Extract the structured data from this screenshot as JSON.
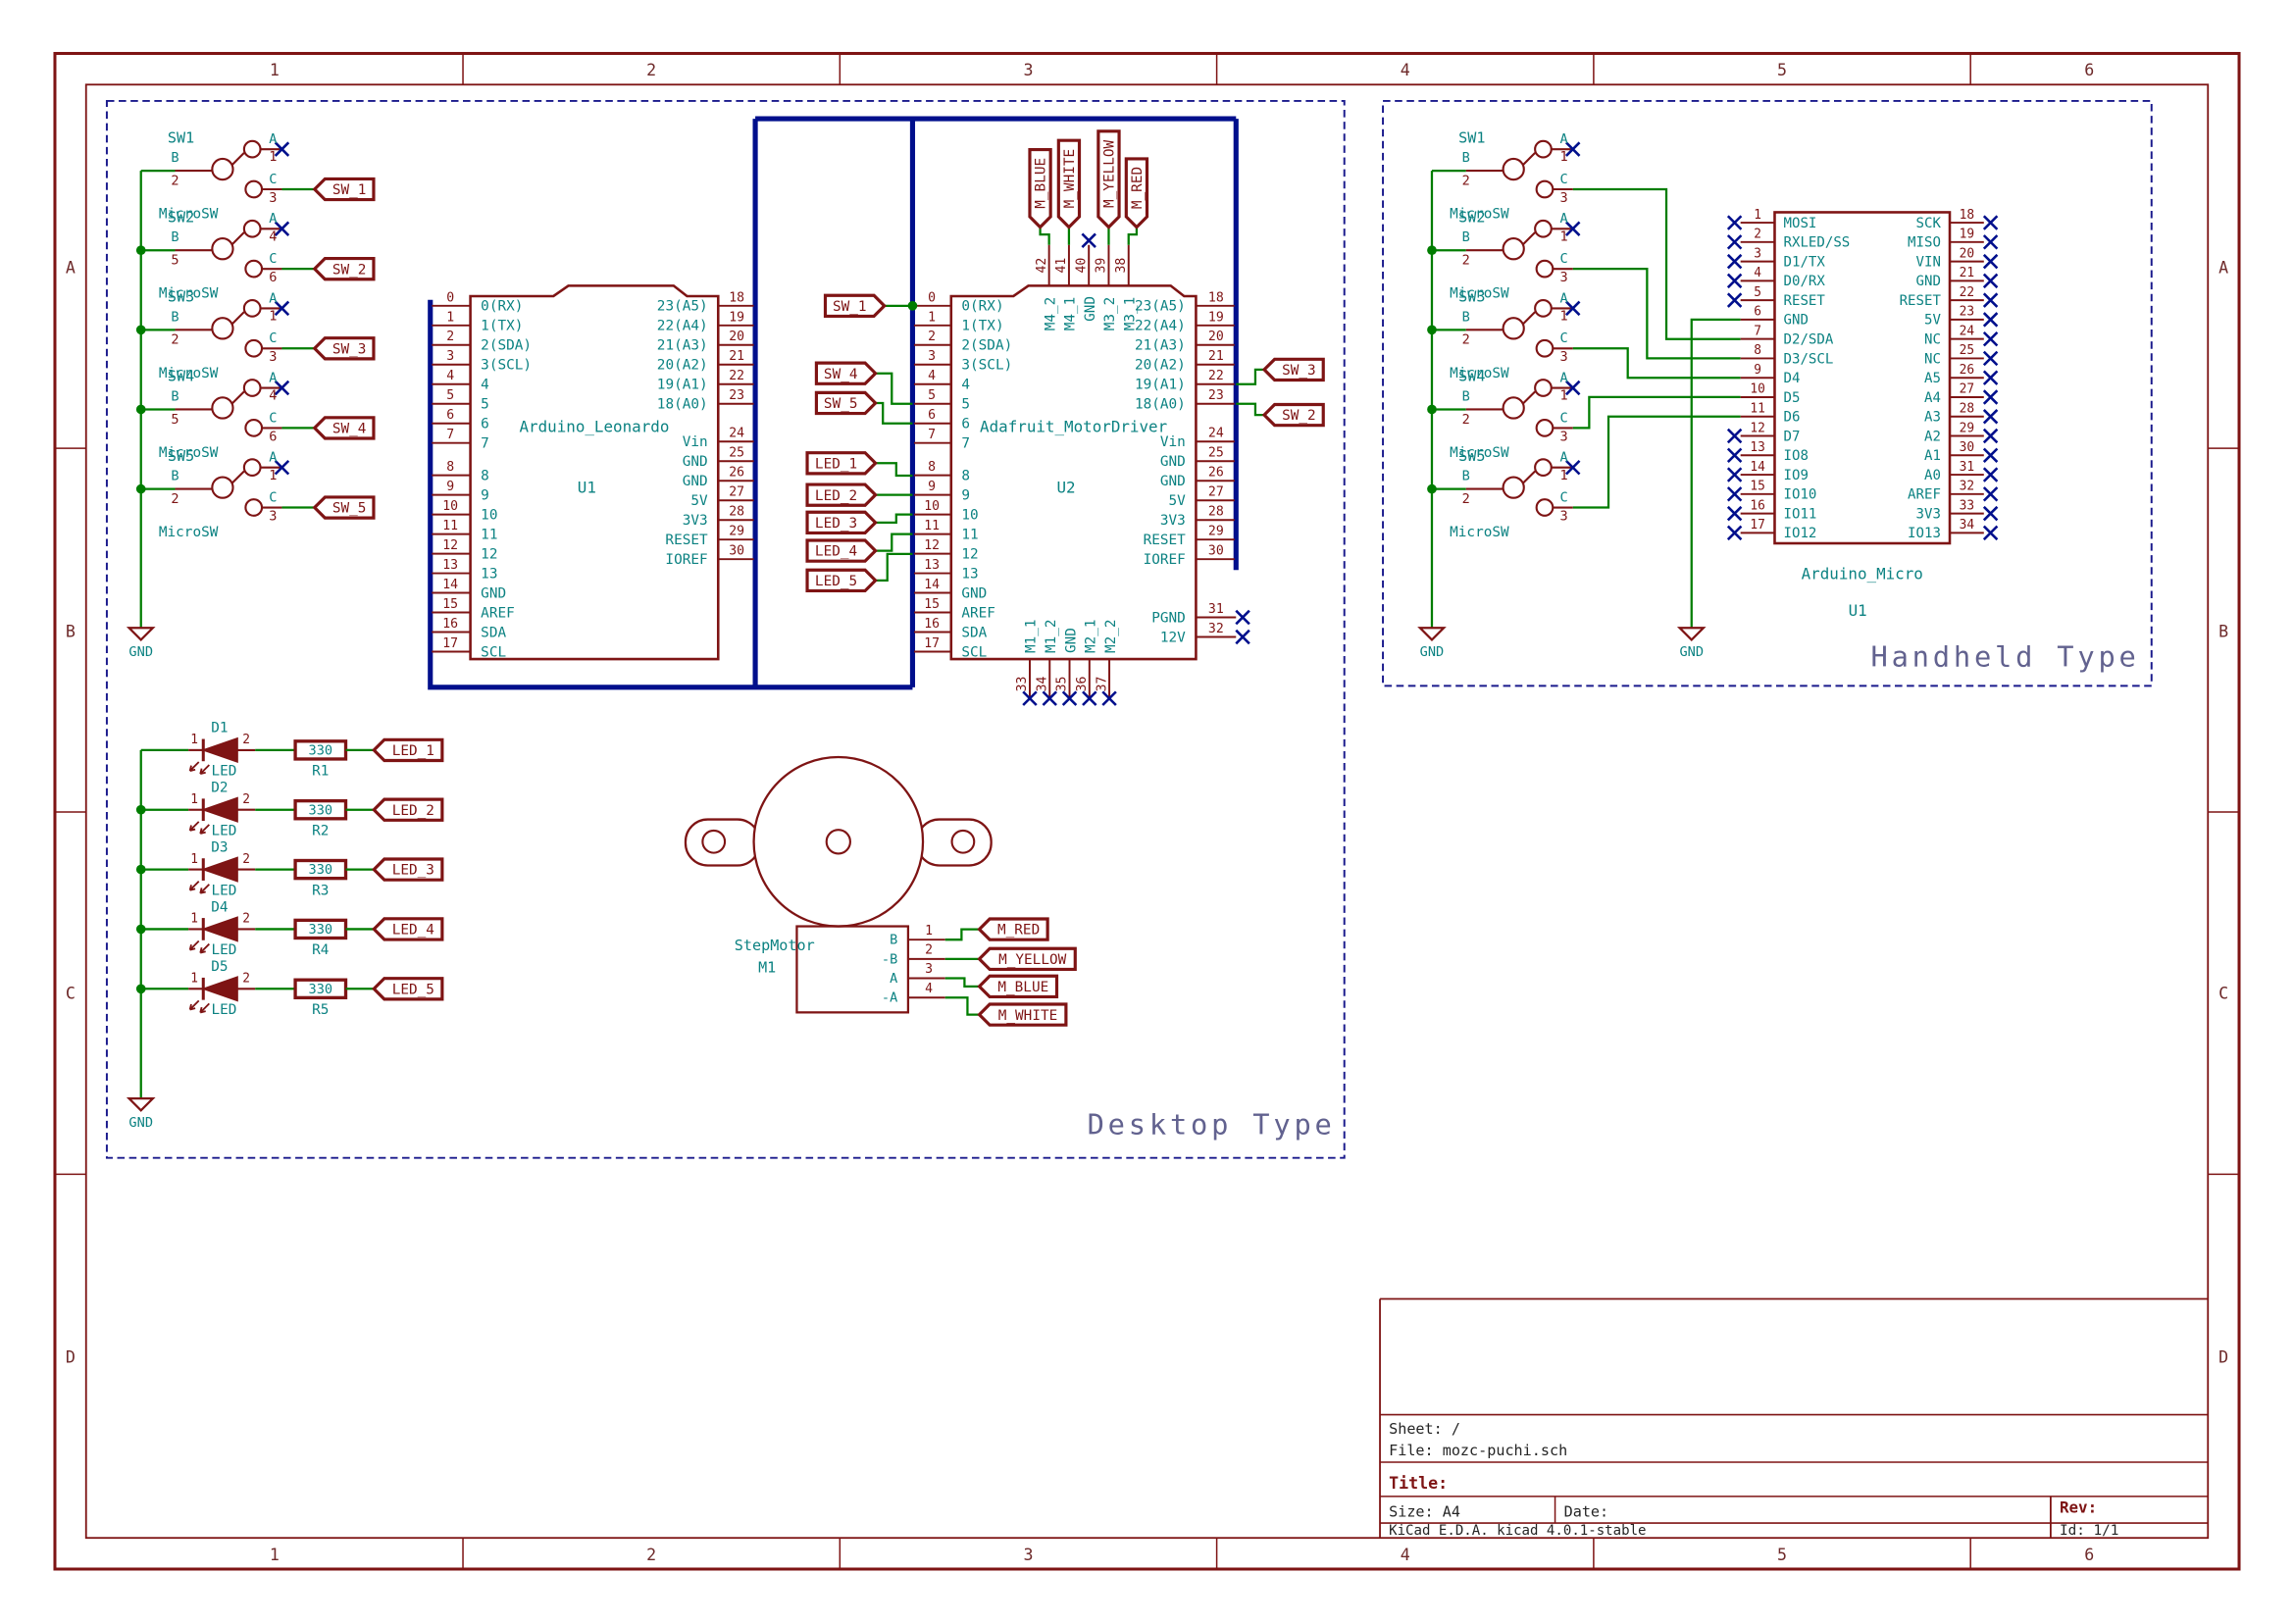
{
  "frame": {
    "columns": [
      "1",
      "2",
      "3",
      "4",
      "5",
      "6"
    ],
    "rows": [
      "A",
      "B",
      "C",
      "D"
    ]
  },
  "title_block": {
    "sheet": "Sheet: /",
    "file": "File: mozc-puchi.sch",
    "title_label": "Title:",
    "size": "Size: A4",
    "date": "Date:",
    "rev": "Rev:",
    "generator": "KiCad E.D.A.  kicad 4.0.1-stable",
    "id": "Id: 1/1"
  },
  "colors": {
    "component": "#7e1414",
    "field_text": "#0c8282",
    "wire": "#007d00",
    "bus": "#000f8c",
    "no_connect": "#000f8c",
    "label": "#7e1414",
    "sheet_box": "#1a1a8c",
    "sheet_text": "#62628f",
    "frame": "#7e1414",
    "frame_text": "#6e2a2a",
    "block_text": "#252525"
  },
  "desktop": {
    "section_label": "Desktop Type",
    "gnd": "GND",
    "switches": [
      {
        "ref": "SW1",
        "value": "MicroSW",
        "b": "B",
        "a": "A",
        "c": "C",
        "pin_b": "2",
        "pin_a": "1",
        "pin_c": "3",
        "net": "SW_1"
      },
      {
        "ref": "SW2",
        "value": "MicroSW",
        "b": "B",
        "a": "A",
        "c": "C",
        "pin_b": "5",
        "pin_a": "4",
        "pin_c": "6",
        "net": "SW_2"
      },
      {
        "ref": "SW3",
        "value": "MicroSW",
        "b": "B",
        "a": "A",
        "c": "C",
        "pin_b": "2",
        "pin_a": "1",
        "pin_c": "3",
        "net": "SW_3"
      },
      {
        "ref": "SW4",
        "value": "MicroSW",
        "b": "B",
        "a": "A",
        "c": "C",
        "pin_b": "5",
        "pin_a": "4",
        "pin_c": "6",
        "net": "SW_4"
      },
      {
        "ref": "SW5",
        "value": "MicroSW",
        "b": "B",
        "a": "A",
        "c": "C",
        "pin_b": "2",
        "pin_a": "1",
        "pin_c": "3",
        "net": "SW_5"
      }
    ],
    "u1": {
      "ref": "U1",
      "name": "Arduino_Leonardo",
      "left_pins": [
        {
          "num": "0",
          "name": "0(RX)"
        },
        {
          "num": "1",
          "name": "1(TX)"
        },
        {
          "num": "2",
          "name": "2(SDA)"
        },
        {
          "num": "3",
          "name": "3(SCL)"
        },
        {
          "num": "4",
          "name": "4"
        },
        {
          "num": "5",
          "name": "5"
        },
        {
          "num": "6",
          "name": "6"
        },
        {
          "num": "7",
          "name": "7"
        },
        {
          "num": "8",
          "name": "8"
        },
        {
          "num": "9",
          "name": "9"
        },
        {
          "num": "10",
          "name": "10"
        },
        {
          "num": "11",
          "name": "11"
        },
        {
          "num": "12",
          "name": "12"
        },
        {
          "num": "13",
          "name": "13"
        },
        {
          "num": "14",
          "name": "GND"
        },
        {
          "num": "15",
          "name": "AREF"
        },
        {
          "num": "16",
          "name": "SDA"
        },
        {
          "num": "17",
          "name": "SCL"
        }
      ],
      "right_pins": [
        {
          "num": "18",
          "name": "23(A5)"
        },
        {
          "num": "19",
          "name": "22(A4)"
        },
        {
          "num": "20",
          "name": "21(A3)"
        },
        {
          "num": "21",
          "name": "20(A2)"
        },
        {
          "num": "22",
          "name": "19(A1)"
        },
        {
          "num": "23",
          "name": "18(A0)"
        },
        {
          "num": "24",
          "name": "Vin"
        },
        {
          "num": "25",
          "name": "GND"
        },
        {
          "num": "26",
          "name": "GND"
        },
        {
          "num": "27",
          "name": "5V"
        },
        {
          "num": "28",
          "name": "3V3"
        },
        {
          "num": "29",
          "name": "RESET"
        },
        {
          "num": "30",
          "name": "IOREF"
        }
      ]
    },
    "u2": {
      "ref": "U2",
      "name": "Adafruit_MotorDriver",
      "left_pins": [
        {
          "num": "0",
          "name": "0(RX)"
        },
        {
          "num": "1",
          "name": "1(TX)"
        },
        {
          "num": "2",
          "name": "2(SDA)"
        },
        {
          "num": "3",
          "name": "3(SCL)"
        },
        {
          "num": "4",
          "name": "4"
        },
        {
          "num": "5",
          "name": "5"
        },
        {
          "num": "6",
          "name": "6"
        },
        {
          "num": "7",
          "name": "7"
        },
        {
          "num": "8",
          "name": "8"
        },
        {
          "num": "9",
          "name": "9"
        },
        {
          "num": "10",
          "name": "10"
        },
        {
          "num": "11",
          "name": "11"
        },
        {
          "num": "12",
          "name": "12"
        },
        {
          "num": "13",
          "name": "13"
        },
        {
          "num": "14",
          "name": "GND"
        },
        {
          "num": "15",
          "name": "AREF"
        },
        {
          "num": "16",
          "name": "SDA"
        },
        {
          "num": "17",
          "name": "SCL"
        }
      ],
      "right_pins": [
        {
          "num": "18",
          "name": "23(A5)"
        },
        {
          "num": "19",
          "name": "22(A4)"
        },
        {
          "num": "20",
          "name": "21(A3)"
        },
        {
          "num": "21",
          "name": "20(A2)"
        },
        {
          "num": "22",
          "name": "19(A1)"
        },
        {
          "num": "23",
          "name": "18(A0)"
        },
        {
          "num": "24",
          "name": "Vin"
        },
        {
          "num": "25",
          "name": "GND"
        },
        {
          "num": "26",
          "name": "GND"
        },
        {
          "num": "27",
          "name": "5V"
        },
        {
          "num": "28",
          "name": "3V3"
        },
        {
          "num": "29",
          "name": "RESET"
        },
        {
          "num": "30",
          "name": "IOREF"
        }
      ],
      "top_pins": [
        {
          "num": "42",
          "name": "M4_2",
          "net": "M_BLUE"
        },
        {
          "num": "41",
          "name": "M4_1",
          "net": "M_WHITE"
        },
        {
          "num": "40",
          "name": "GND"
        },
        {
          "num": "39",
          "name": "M3_2",
          "net": "M_YELLOW"
        },
        {
          "num": "38",
          "name": "M3_1",
          "net": "M_RED"
        }
      ],
      "power_pins": [
        {
          "num": "31",
          "name": "PGND"
        },
        {
          "num": "32",
          "name": "12V"
        }
      ],
      "bottom_pins": [
        {
          "num": "33",
          "name": "M1_1"
        },
        {
          "num": "34",
          "name": "M1_2"
        },
        {
          "num": "35",
          "name": "GND"
        },
        {
          "num": "36",
          "name": "M2_1"
        },
        {
          "num": "37",
          "name": "M2_2"
        }
      ],
      "left_nets": [
        "SW_1",
        "SW_4",
        "SW_5",
        "LED_1",
        "LED_2",
        "LED_3",
        "LED_4",
        "LED_5"
      ],
      "right_nets": [
        "SW_3",
        "SW_2"
      ]
    },
    "leds": [
      {
        "ref": "D1",
        "value": "LED",
        "pin1": "1",
        "pin2": "2",
        "res_ref": "R1",
        "res_value": "330",
        "net": "LED_1"
      },
      {
        "ref": "D2",
        "value": "LED",
        "pin1": "1",
        "pin2": "2",
        "res_ref": "R2",
        "res_value": "330",
        "net": "LED_2"
      },
      {
        "ref": "D3",
        "value": "LED",
        "pin1": "1",
        "pin2": "2",
        "res_ref": "R3",
        "res_value": "330",
        "net": "LED_3"
      },
      {
        "ref": "D4",
        "value": "LED",
        "pin1": "1",
        "pin2": "2",
        "res_ref": "R4",
        "res_value": "330",
        "net": "LED_4"
      },
      {
        "ref": "D5",
        "value": "LED",
        "pin1": "1",
        "pin2": "2",
        "res_ref": "R5",
        "res_value": "330",
        "net": "LED_5"
      }
    ],
    "motor": {
      "ref": "M1",
      "name": "StepMotor",
      "pins": [
        {
          "name": "B",
          "num": "1",
          "net": "M_RED"
        },
        {
          "name": "-B",
          "num": "2",
          "net": "M_YELLOW"
        },
        {
          "name": "A",
          "num": "3",
          "net": "M_BLUE"
        },
        {
          "name": "-A",
          "num": "4",
          "net": "M_WHITE"
        }
      ]
    }
  },
  "handheld": {
    "section_label": "Handheld Type",
    "gnd": "GND",
    "switches": [
      {
        "ref": "SW1",
        "value": "MicroSW",
        "b": "B",
        "a": "A",
        "c": "C",
        "pin_b": "2",
        "pin_a": "1",
        "pin_c": "3"
      },
      {
        "ref": "SW2",
        "value": "MicroSW",
        "b": "B",
        "a": "A",
        "c": "C",
        "pin_b": "2",
        "pin_a": "1",
        "pin_c": "3"
      },
      {
        "ref": "SW3",
        "value": "MicroSW",
        "b": "B",
        "a": "A",
        "c": "C",
        "pin_b": "2",
        "pin_a": "1",
        "pin_c": "3"
      },
      {
        "ref": "SW4",
        "value": "MicroSW",
        "b": "B",
        "a": "A",
        "c": "C",
        "pin_b": "2",
        "pin_a": "1",
        "pin_c": "3"
      },
      {
        "ref": "SW5",
        "value": "MicroSW",
        "b": "B",
        "a": "A",
        "c": "C",
        "pin_b": "2",
        "pin_a": "1",
        "pin_c": "3"
      }
    ],
    "micro": {
      "ref": "U1",
      "name": "Arduino_Micro",
      "left_pins": [
        {
          "num": "1",
          "name": "MOSI",
          "nc": true
        },
        {
          "num": "2",
          "name": "RXLED/SS",
          "nc": true
        },
        {
          "num": "3",
          "name": "D1/TX",
          "nc": true
        },
        {
          "num": "4",
          "name": "D0/RX",
          "nc": true
        },
        {
          "num": "5",
          "name": "RESET",
          "nc": true
        },
        {
          "num": "6",
          "name": "GND"
        },
        {
          "num": "7",
          "name": "D2/SDA"
        },
        {
          "num": "8",
          "name": "D3/SCL"
        },
        {
          "num": "9",
          "name": "D4"
        },
        {
          "num": "10",
          "name": "D5"
        },
        {
          "num": "11",
          "name": "D6"
        },
        {
          "num": "12",
          "name": "D7",
          "nc": true
        },
        {
          "num": "13",
          "name": "IO8",
          "nc": true
        },
        {
          "num": "14",
          "name": "IO9",
          "nc": true
        },
        {
          "num": "15",
          "name": "IO10",
          "nc": true
        },
        {
          "num": "16",
          "name": "IO11",
          "nc": true
        },
        {
          "num": "17",
          "name": "IO12",
          "nc": true
        }
      ],
      "right_pins": [
        {
          "num": "18",
          "name": "SCK",
          "nc": true
        },
        {
          "num": "19",
          "name": "MISO",
          "nc": true
        },
        {
          "num": "20",
          "name": "VIN",
          "nc": true
        },
        {
          "num": "21",
          "name": "GND",
          "nc": true
        },
        {
          "num": "22",
          "name": "RESET",
          "nc": true
        },
        {
          "num": "23",
          "name": "5V",
          "nc": true
        },
        {
          "num": "24",
          "name": "NC",
          "nc": true
        },
        {
          "num": "25",
          "name": "NC",
          "nc": true
        },
        {
          "num": "26",
          "name": "A5",
          "nc": true
        },
        {
          "num": "27",
          "name": "A4",
          "nc": true
        },
        {
          "num": "28",
          "name": "A3",
          "nc": true
        },
        {
          "num": "29",
          "name": "A2",
          "nc": true
        },
        {
          "num": "30",
          "name": "A1",
          "nc": true
        },
        {
          "num": "31",
          "name": "A0",
          "nc": true
        },
        {
          "num": "32",
          "name": "AREF",
          "nc": true
        },
        {
          "num": "33",
          "name": "3V3",
          "nc": true
        },
        {
          "num": "34",
          "name": "IO13",
          "nc": true
        }
      ]
    }
  }
}
